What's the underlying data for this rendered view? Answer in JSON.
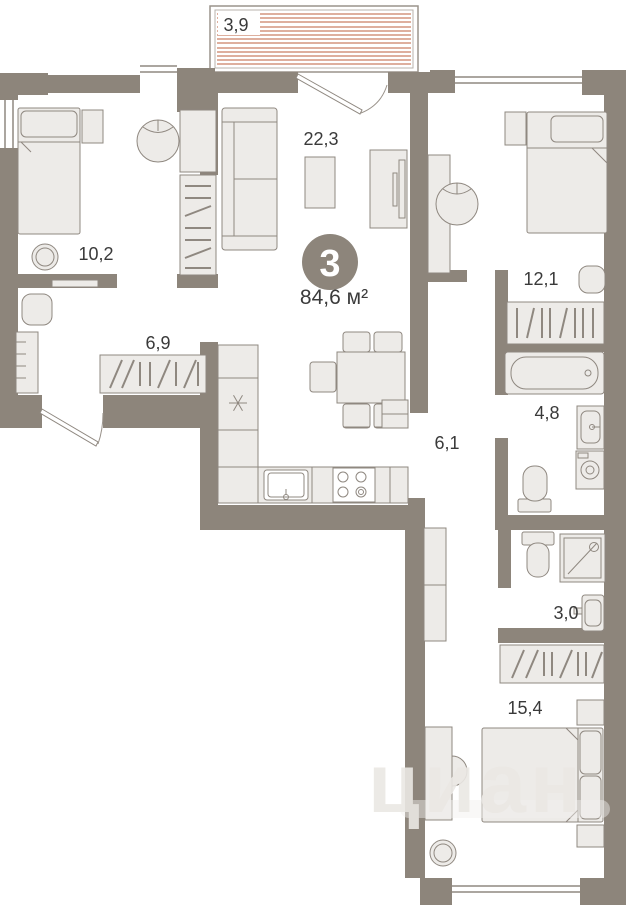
{
  "floorplan": {
    "badge": {
      "rooms_count": "3",
      "total_area": "84,6 м²"
    },
    "balcony_label": "3,9",
    "rooms": {
      "living": "22,3",
      "bedroom_left": "10,2",
      "bedroom_right": "12,1",
      "hallway": "6,9",
      "corridor": "6,1",
      "bathroom": "4,8",
      "wc": "3,0",
      "bedroom_master": "15,4"
    },
    "watermark": "циан",
    "colors": {
      "wall": "#8d857b",
      "furniture_fill": "#edebe8",
      "furniture_stroke": "#8f8880",
      "balcony_hatch": "#c97f63",
      "label_text": "#3a3a3a",
      "badge_background": "#8d857b",
      "badge_text": "#ffffff",
      "watermark_text": "#ebe8e4"
    }
  }
}
